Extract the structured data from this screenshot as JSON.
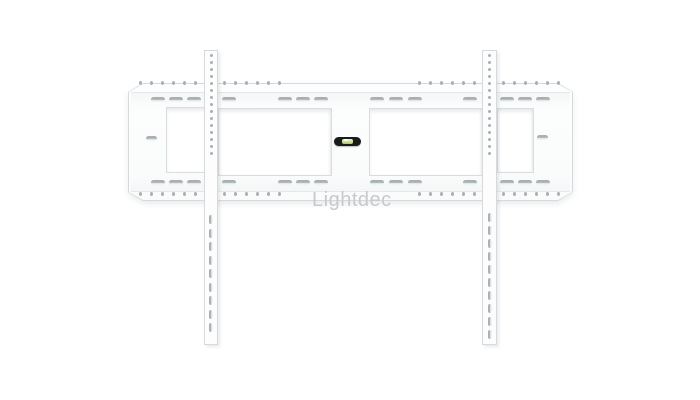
{
  "watermark": {
    "text": "Lightdec"
  },
  "colors": {
    "background": "#ffffff",
    "plate_body": "#fdfdfe",
    "outline": "#d6dadd",
    "hole_dark": "#a8b0b4",
    "hole_light": "#f0f3f4",
    "tint": "#f4f6f7",
    "level_body": "#1b1b1b",
    "level_vial": "#cbe290",
    "watermark": "#c6cacd"
  },
  "bracket": {
    "round_hole_rows": [
      {
        "y": 81,
        "pitch": 11,
        "groups": [
          [
            140,
            6
          ],
          [
            224,
            6
          ],
          [
            419,
            6
          ],
          [
            503,
            6
          ]
        ]
      },
      {
        "y": 192,
        "pitch": 11,
        "groups": [
          [
            140,
            6
          ],
          [
            224,
            6
          ],
          [
            419,
            6
          ],
          [
            503,
            6
          ]
        ]
      }
    ],
    "slot_rows": [
      {
        "y": 97,
        "xs": [
          151,
          169,
          187,
          222,
          278,
          296,
          314,
          370,
          389,
          408,
          463,
          500,
          518,
          536
        ]
      },
      {
        "y": 180,
        "xs": [
          151,
          169,
          187,
          222,
          278,
          296,
          314,
          370,
          389,
          408,
          463,
          500,
          518,
          536
        ]
      }
    ],
    "mid_slots": [
      {
        "x": 146,
        "y": 136
      },
      {
        "x": 537,
        "y": 135
      }
    ],
    "rails": [
      {
        "x": 204,
        "w": 14,
        "dot_y0": 54,
        "dot_n": 15,
        "dot_pitch": 7,
        "slot_y0": 215,
        "slot_n": 9,
        "slot_pitch": 13.5
      },
      {
        "x": 482,
        "w": 15,
        "dot_y0": 54,
        "dot_n": 15,
        "dot_pitch": 7,
        "slot_y0": 213,
        "slot_n": 10,
        "slot_pitch": 13
      }
    ]
  }
}
